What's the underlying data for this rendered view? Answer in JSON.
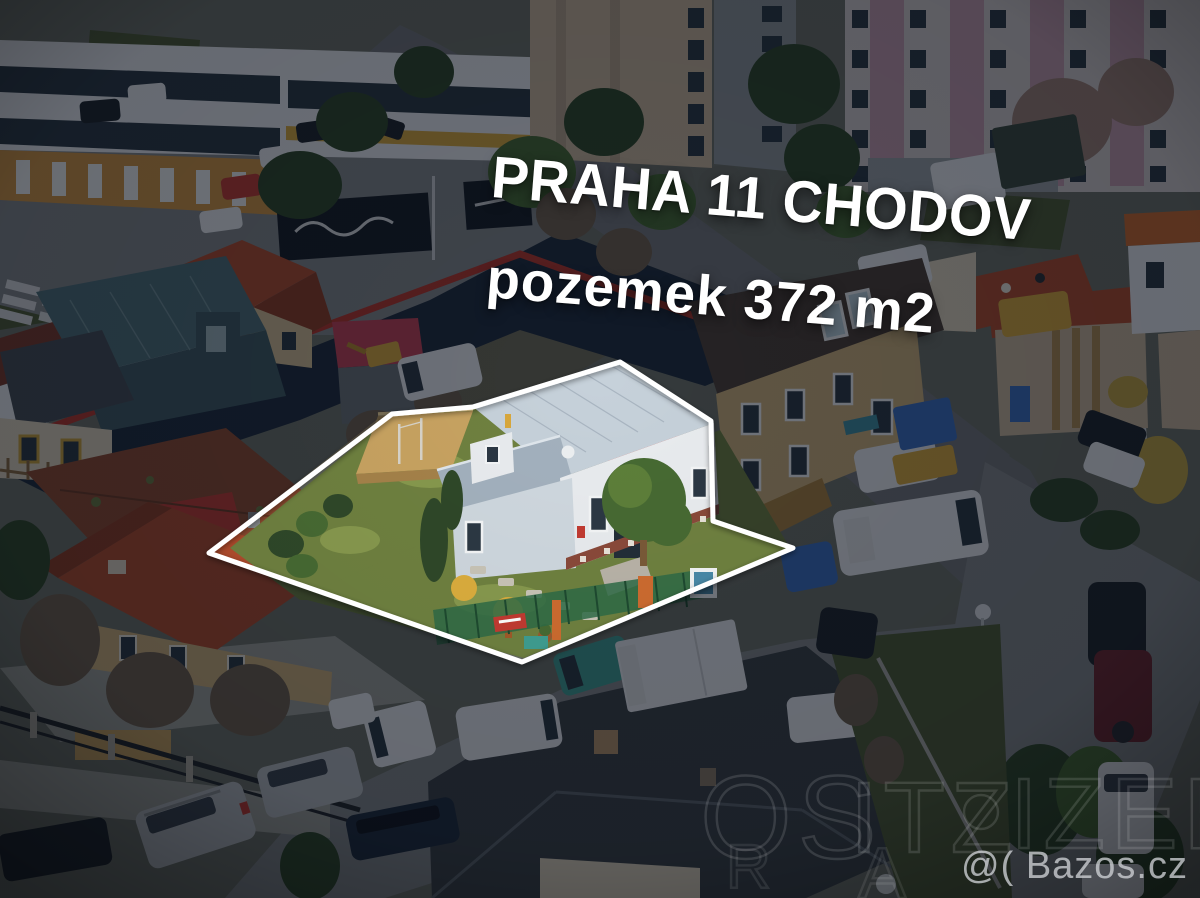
{
  "photo": {
    "description": "aerial real-estate photo of a family house plot in a city neighborhood",
    "location_line": "PRAHA 11 CHODOV",
    "plot_line": "pozemek 372 m2"
  },
  "overlay": {
    "text_color": "#ffffff",
    "rotation_deg": 4.6
  },
  "boundary": {
    "outline_color": "#ffffff",
    "shape": "property-polygon-highlight"
  },
  "watermarks": {
    "brand": "@( Bazos.cz",
    "brand_color": "#cdd0d4",
    "faint_letters": [
      "OS",
      "ITZ",
      "IZER",
      "R",
      "A"
    ]
  },
  "palette": {
    "dark_overlay": "#060b15",
    "subject_house_wall": "#e9ecef",
    "subject_house_roof": "#c6d1da",
    "garden_grass": "#6f8140",
    "golden_shrub": "#dcae3e",
    "mesh_fence": "#31724b",
    "brick_wall": "#c8a361",
    "red_tile_roof": "#b14c2d",
    "panel_building_pink": "#c49cae",
    "retail_band_navy": "#1e2b3c",
    "retail_stripe_red": "#b5352c"
  }
}
